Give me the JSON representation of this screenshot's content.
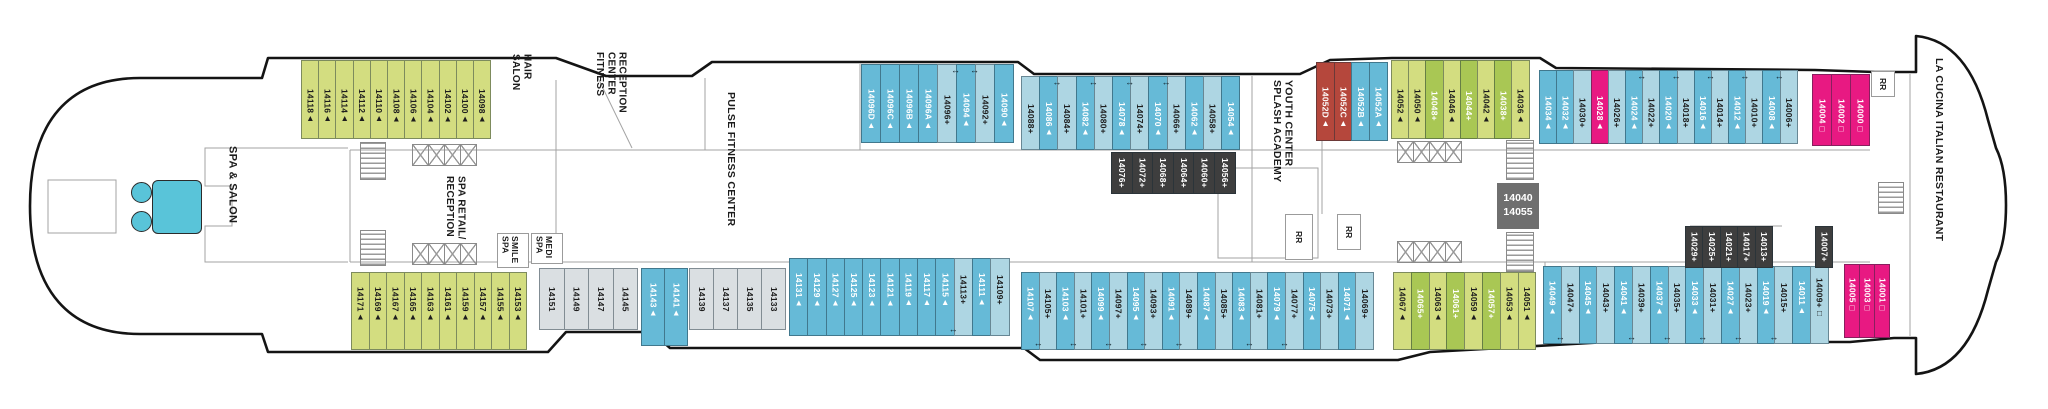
{
  "deck": {
    "mid_box": {
      "line1": "14040",
      "line2": "14055"
    },
    "rr_label": "RR",
    "labels": {
      "spa_salon": "SPA & SALON",
      "hair_salon": "HAIR\nSALON",
      "fitness_reception": "FITNESS\nCENTER\nRECEPTION",
      "pulse": "PULSE FITNESS CENTER",
      "spa_retail": "SPA RETAIL/\nRECEPTION",
      "smile_spa": "SMILE\nSPA",
      "medi_spa": "MEDI\nSPA",
      "splash": "SPLASH ACADEMY\nYOUTH CENTER",
      "la_cucina": "LA CUCINA ITALIAN RESTAURANT"
    },
    "palette": {
      "lime": "#d3dd80",
      "limeDark": "#a9c754",
      "blueMid": "#66bad7",
      "blueLight": "#aed6e3",
      "gray": "#dadfe2",
      "red": "#b5473c",
      "pink": "#e81982",
      "dark": "#3e3e3e",
      "midBox": "#6f6f6f",
      "tub": "#59c4d9",
      "textDark": "#1d1d1d",
      "textLight": "#ffffff"
    },
    "strips": {
      "top_lime": [
        {
          "label": "14118▲",
          "cat": "lime"
        },
        {
          "label": "14116▲",
          "cat": "lime"
        },
        {
          "label": "14114▲",
          "cat": "lime"
        },
        {
          "label": "14112▲",
          "cat": "lime"
        },
        {
          "label": "14110▲",
          "cat": "lime"
        },
        {
          "label": "14108▲",
          "cat": "lime"
        },
        {
          "label": "14106▲",
          "cat": "lime"
        },
        {
          "label": "14104▲",
          "cat": "lime"
        },
        {
          "label": "14102▲",
          "cat": "lime"
        },
        {
          "label": "14100▲",
          "cat": "lime"
        },
        {
          "label": "14098▲",
          "cat": "lime"
        }
      ],
      "top_blue_a": [
        {
          "label": "14096D▲",
          "cat": "blueMid"
        },
        {
          "label": "14096C▲",
          "cat": "blueMid"
        },
        {
          "label": "14096B▲",
          "cat": "blueMid"
        },
        {
          "label": "14096A▲",
          "cat": "blueMid"
        },
        {
          "label": "14096+",
          "cat": "blueLight"
        },
        {
          "label": "14094▲",
          "cat": "blueMid",
          "arrow": true
        },
        {
          "label": "14092+",
          "cat": "blueLight",
          "arrow": true
        },
        {
          "label": "14090▲",
          "cat": "blueMid"
        }
      ],
      "top_blue_b": [
        {
          "label": "14088+",
          "cat": "blueLight"
        },
        {
          "label": "14086▲",
          "cat": "blueMid"
        },
        {
          "label": "14084+",
          "cat": "blueLight",
          "arrow": true
        },
        {
          "label": "14082▲",
          "cat": "blueMid"
        },
        {
          "label": "14080+",
          "cat": "blueLight",
          "arrow": true
        },
        {
          "label": "14078▲",
          "cat": "blueMid"
        },
        {
          "label": "14074+",
          "cat": "blueLight",
          "arrow": true
        },
        {
          "label": "14070▲",
          "cat": "blueMid"
        },
        {
          "label": "14066+",
          "cat": "blueLight",
          "arrow": true
        },
        {
          "label": "14062▲",
          "cat": "blueMid"
        },
        {
          "label": "14058+",
          "cat": "blueLight"
        },
        {
          "label": "14054▲",
          "cat": "blueMid"
        }
      ],
      "top_inside": [
        {
          "label": "14076+",
          "cat": "dark"
        },
        {
          "label": "14072+",
          "cat": "dark"
        },
        {
          "label": "14068+",
          "cat": "dark"
        },
        {
          "label": "14064+",
          "cat": "dark"
        },
        {
          "label": "14060+",
          "cat": "dark"
        },
        {
          "label": "14056+",
          "cat": "dark"
        }
      ],
      "top_splash": [
        {
          "label": "14052D▲",
          "cat": "red"
        },
        {
          "label": "14052C▲",
          "cat": "red"
        },
        {
          "label": "14052B▲",
          "cat": "blueMid"
        },
        {
          "label": "14052A▲",
          "cat": "blueMid"
        }
      ],
      "top_green": [
        {
          "label": "14052▲",
          "cat": "lime"
        },
        {
          "label": "14050▲",
          "cat": "lime"
        },
        {
          "label": "14048+",
          "cat": "limeDark"
        },
        {
          "label": "14046▲",
          "cat": "lime"
        },
        {
          "label": "14044+",
          "cat": "limeDark"
        },
        {
          "label": "14042▲",
          "cat": "lime"
        },
        {
          "label": "14038+",
          "cat": "limeDark"
        },
        {
          "label": "14036▲",
          "cat": "lime"
        }
      ],
      "top_blue_c": [
        {
          "label": "14034▲",
          "cat": "blueMid"
        },
        {
          "label": "14032▲",
          "cat": "blueMid"
        },
        {
          "label": "14030+",
          "cat": "blueLight"
        },
        {
          "label": "14028▲",
          "cat": "pink"
        },
        {
          "label": "14026+",
          "cat": "blueLight"
        },
        {
          "label": "14024▲",
          "cat": "blueMid"
        },
        {
          "label": "14022+",
          "cat": "blueLight",
          "arrow": true
        },
        {
          "label": "14020▲",
          "cat": "blueMid"
        },
        {
          "label": "14018+",
          "cat": "blueLight",
          "arrow": true
        },
        {
          "label": "14016▲",
          "cat": "blueMid"
        },
        {
          "label": "14014+",
          "cat": "blueLight",
          "arrow": true
        },
        {
          "label": "14012▲",
          "cat": "blueMid"
        },
        {
          "label": "14010+",
          "cat": "blueLight",
          "arrow": true
        },
        {
          "label": "14008▲",
          "cat": "blueMid"
        },
        {
          "label": "14006+",
          "cat": "blueLight",
          "arrow": true
        }
      ],
      "top_pink": [
        {
          "label": "14004□",
          "cat": "pink"
        },
        {
          "label": "14002□",
          "cat": "pink"
        },
        {
          "label": "14000□",
          "cat": "pink"
        }
      ],
      "bot_lime": [
        {
          "label": "14171▲",
          "cat": "lime"
        },
        {
          "label": "14169▲",
          "cat": "lime"
        },
        {
          "label": "14167▲",
          "cat": "lime"
        },
        {
          "label": "14165▲",
          "cat": "lime"
        },
        {
          "label": "14163▲",
          "cat": "lime"
        },
        {
          "label": "14161▲",
          "cat": "lime"
        },
        {
          "label": "14159▲",
          "cat": "lime"
        },
        {
          "label": "14157▲",
          "cat": "lime"
        },
        {
          "label": "14155▲",
          "cat": "lime"
        },
        {
          "label": "14153▲",
          "cat": "lime"
        }
      ],
      "bot_gray_a": [
        {
          "label": "14151",
          "cat": "gray"
        },
        {
          "label": "14149",
          "cat": "gray"
        },
        {
          "label": "14147",
          "cat": "gray"
        },
        {
          "label": "14145",
          "cat": "gray"
        }
      ],
      "bot_blue_pair": [
        {
          "label": "14143▲",
          "cat": "blueMid"
        },
        {
          "label": "14141▲",
          "cat": "blueMid"
        }
      ],
      "bot_gray_b": [
        {
          "label": "14139",
          "cat": "gray"
        },
        {
          "label": "14137",
          "cat": "gray"
        },
        {
          "label": "14135",
          "cat": "gray"
        },
        {
          "label": "14133",
          "cat": "gray"
        }
      ],
      "bot_blue_a": [
        {
          "label": "14131▲",
          "cat": "blueMid"
        },
        {
          "label": "14129▲",
          "cat": "blueMid"
        },
        {
          "label": "14127▲",
          "cat": "blueMid"
        },
        {
          "label": "14125▲",
          "cat": "blueMid"
        },
        {
          "label": "14123▲",
          "cat": "blueMid"
        },
        {
          "label": "14121▲",
          "cat": "blueMid"
        },
        {
          "label": "14119▲",
          "cat": "blueMid"
        },
        {
          "label": "14117▲",
          "cat": "blueMid"
        },
        {
          "label": "14115▲",
          "cat": "blueMid"
        },
        {
          "label": "14113+",
          "cat": "blueLight",
          "arrow": true
        },
        {
          "label": "14111▲",
          "cat": "blueMid"
        },
        {
          "label": "14109+",
          "cat": "blueLight"
        }
      ],
      "bot_blue_b": [
        {
          "label": "14107▲",
          "cat": "blueMid"
        },
        {
          "label": "14105+",
          "cat": "blueLight",
          "arrow": true
        },
        {
          "label": "14103▲",
          "cat": "blueMid"
        },
        {
          "label": "14101+",
          "cat": "blueLight",
          "arrow": true
        },
        {
          "label": "14099▲",
          "cat": "blueMid"
        },
        {
          "label": "14097+",
          "cat": "blueLight",
          "arrow": true
        },
        {
          "label": "14095▲",
          "cat": "blueMid"
        },
        {
          "label": "14093+",
          "cat": "blueLight",
          "arrow": true
        },
        {
          "label": "14091▲",
          "cat": "blueMid"
        },
        {
          "label": "14089+",
          "cat": "blueLight",
          "arrow": true
        },
        {
          "label": "14087▲",
          "cat": "blueMid"
        },
        {
          "label": "14085+",
          "cat": "blueLight"
        },
        {
          "label": "14083▲",
          "cat": "blueMid"
        },
        {
          "label": "14081+",
          "cat": "blueLight",
          "arrow": true
        },
        {
          "label": "14079▲",
          "cat": "blueMid"
        },
        {
          "label": "14077+",
          "cat": "blueLight",
          "arrow": true
        },
        {
          "label": "14075▲",
          "cat": "blueMid"
        },
        {
          "label": "14073+",
          "cat": "blueLight"
        },
        {
          "label": "14071▲",
          "cat": "blueMid"
        },
        {
          "label": "14069+",
          "cat": "blueLight"
        }
      ],
      "bot_green": [
        {
          "label": "14067▲",
          "cat": "lime"
        },
        {
          "label": "14065+",
          "cat": "limeDark"
        },
        {
          "label": "14063▲",
          "cat": "lime"
        },
        {
          "label": "14061+",
          "cat": "limeDark"
        },
        {
          "label": "14059▲",
          "cat": "lime"
        },
        {
          "label": "14057+",
          "cat": "limeDark"
        },
        {
          "label": "14053▲",
          "cat": "lime"
        },
        {
          "label": "14051▲",
          "cat": "lime"
        }
      ],
      "bot_blue_c": [
        {
          "label": "14049▲",
          "cat": "blueMid"
        },
        {
          "label": "14047+",
          "cat": "blueLight",
          "arrow": true
        },
        {
          "label": "14045▲",
          "cat": "blueMid"
        },
        {
          "label": "14043+",
          "cat": "blueLight"
        },
        {
          "label": "14041▲",
          "cat": "blueMid"
        },
        {
          "label": "14039+",
          "cat": "blueLight",
          "arrow": true
        },
        {
          "label": "14037▲",
          "cat": "blueMid"
        },
        {
          "label": "14035+",
          "cat": "blueLight",
          "arrow": true
        },
        {
          "label": "14033▲",
          "cat": "blueMid"
        },
        {
          "label": "14031+",
          "cat": "blueLight",
          "arrow": true
        },
        {
          "label": "14027▲",
          "cat": "blueMid"
        },
        {
          "label": "14023+",
          "cat": "blueLight",
          "arrow": true
        },
        {
          "label": "14019▲",
          "cat": "blueMid"
        },
        {
          "label": "14015+",
          "cat": "blueLight",
          "arrow": true
        },
        {
          "label": "14011▲",
          "cat": "blueMid"
        },
        {
          "label": "14009+□",
          "cat": "blueLight"
        }
      ],
      "bot_pink": [
        {
          "label": "14005□",
          "cat": "pink"
        },
        {
          "label": "14003□",
          "cat": "pink"
        },
        {
          "label": "14001□",
          "cat": "pink"
        }
      ],
      "bot_inside": [
        {
          "label": "14029+",
          "cat": "dark"
        },
        {
          "label": "14025+",
          "cat": "dark"
        },
        {
          "label": "14021+",
          "cat": "dark"
        },
        {
          "label": "14017+",
          "cat": "dark"
        },
        {
          "label": "14013+",
          "cat": "dark"
        }
      ],
      "bot_inside2": [
        {
          "label": "14007+",
          "cat": "dark"
        }
      ]
    }
  }
}
